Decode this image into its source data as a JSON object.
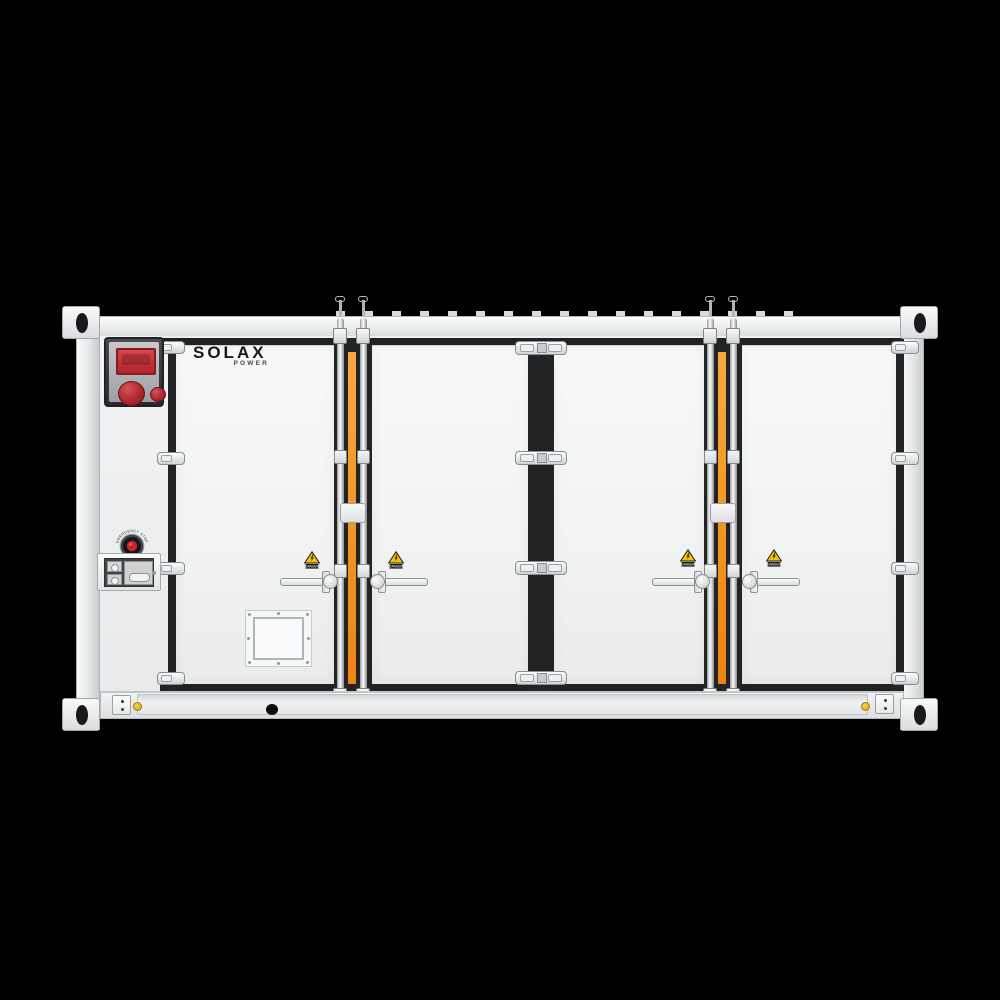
{
  "scene": {
    "type": "product-render",
    "subject": "Containerized battery energy storage system, front view",
    "background_color": "#000000"
  },
  "brand": {
    "name": "SOLAX",
    "subname": "POWER"
  },
  "labels": {
    "emergency_stop": "EMERGENCY STOP",
    "danger": "DANGER"
  },
  "colors": {
    "body_white": "#f1f2f3",
    "door_seal_black": "#1f2123",
    "accent_orange": "#f28a1e",
    "alarm_red": "#bf2a32",
    "button_red": "#c8252b",
    "sticker_yellow": "#f4c500",
    "metal_gray": "#c9cccd"
  },
  "hardware": {
    "door_count": 4,
    "danger_sticker_count": 4,
    "lock_rod_columns": 2,
    "hinge_rows": 4,
    "corner_castings": 4
  }
}
